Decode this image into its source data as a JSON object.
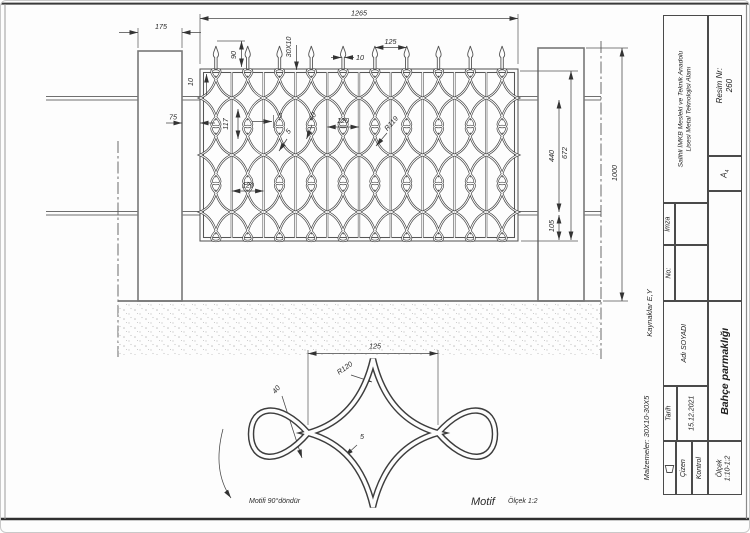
{
  "page": {
    "bg": "#fdfdfd",
    "border_color": "#3a3a3a",
    "line_color": "#4a4a4a"
  },
  "title_block": {
    "school_line1": "Salihli İMKB Mesleki ve Teknik Anadolu",
    "school_line2": "Lisesi Metal Teknolojisi Alanı",
    "resim_label": "Resim Nr:",
    "resim_value": "260",
    "paper_letter": "A",
    "paper_sub": "4",
    "imza_label": "İmza",
    "no_label": "No:",
    "name_value": "Adı SOYADI",
    "tarih_label": "Tarih",
    "tarih_value": "15.12.2021",
    "cizen_label": "Çizen",
    "kontrol_label": "Kontrol",
    "olcek_label": "Ölçek",
    "olcek_value": "1:10-1:2",
    "drawing_title": "Bahçe parmaklığı"
  },
  "side_notes": {
    "kaynaklar": "Kaynaklar E,Y",
    "malzemeler": "Malzemeler: 30X10-30X5"
  },
  "main_view": {
    "dim_total_width": "1265",
    "dim_pillar_width": "175",
    "dim_spear_pitch": "125",
    "dim_spear_height": "90",
    "dim_profile": "30X10",
    "dim_bar_10": "10",
    "dim_rail_10": "10",
    "dim_gap_75": "75",
    "dim_pitch_117": "117",
    "dim_5_bar": "5",
    "dim_5_strip": "5",
    "dim_loop_40": "40",
    "dim_col_120a": "120",
    "dim_col_120b": "120",
    "dim_r119": "R119",
    "dim_440": "440",
    "dim_672": "672",
    "dim_105": "105",
    "dim_1000": "1000"
  },
  "detail_view": {
    "dim_125": "125",
    "dim_r120": "R120",
    "dim_40": "40",
    "dim_5": "5",
    "note_rotate": "Motifi 90°döndür",
    "caption": "Motif",
    "scale_note": "Ölçek 1:2"
  }
}
